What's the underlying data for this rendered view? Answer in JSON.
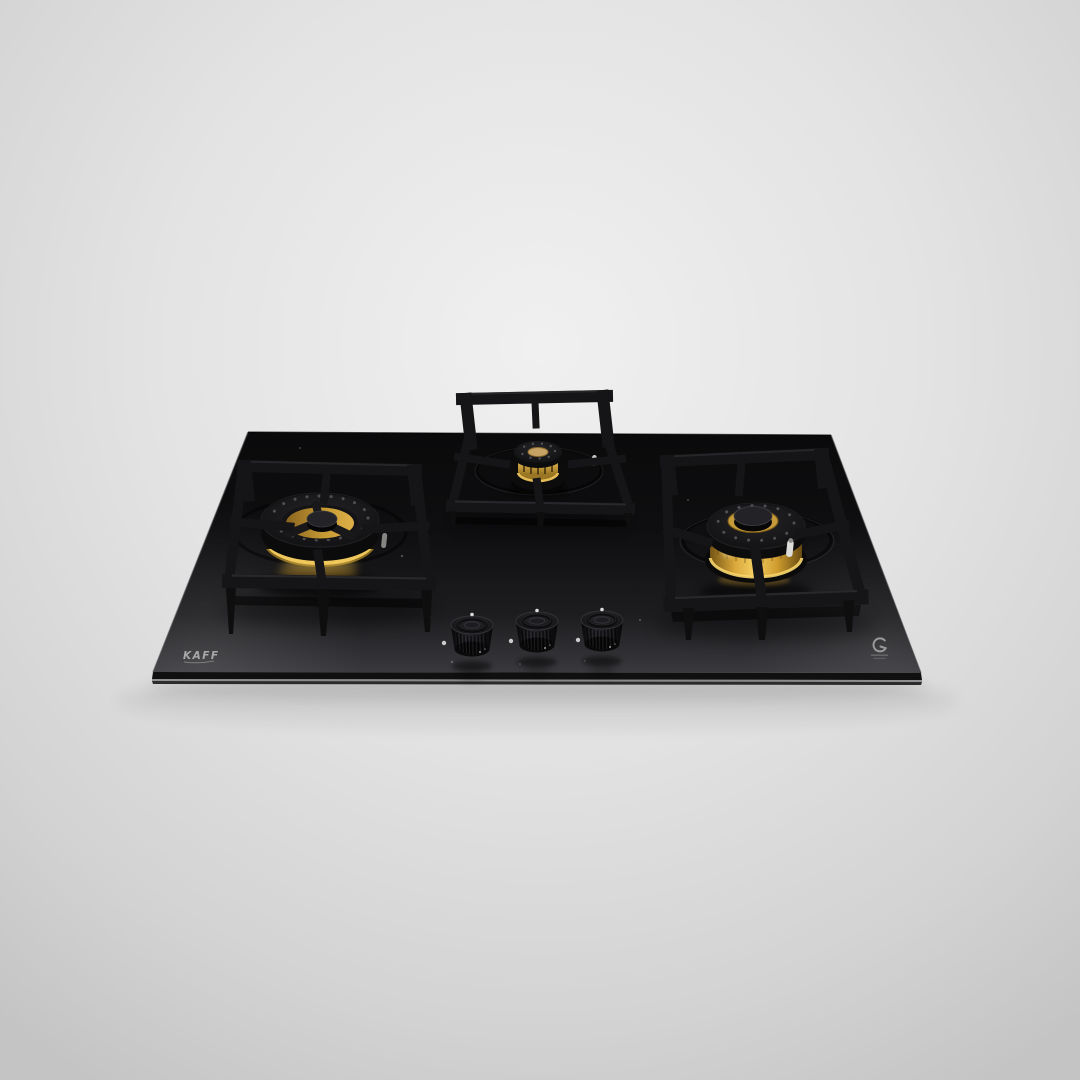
{
  "scene": {
    "type": "product-photograph",
    "subject": "Built-in 3-burner gas hob on black toughened glass, angled studio shot",
    "background_color": "#e3e3e3"
  },
  "hob": {
    "brand": "KAFF",
    "glass_color": "#121214",
    "brass_color": "#d9a73a",
    "frame_color": "#151518",
    "burner_count": 3,
    "burners": [
      {
        "id": "left-burner",
        "size": "large",
        "style": "brass ring burner, black cap, cast-iron square pan support"
      },
      {
        "id": "middle-burner",
        "size": "small",
        "style": "brass crown burner, black cap, raised cast-iron pan support"
      },
      {
        "id": "right-burner",
        "size": "large",
        "style": "wide bright brass band, black cap, white igniter pin"
      }
    ],
    "knobs": {
      "count": 3,
      "indicator_color": "#e0e0e0",
      "style": "knurled black metal"
    },
    "certification_icon": "circular-glass-mark"
  }
}
